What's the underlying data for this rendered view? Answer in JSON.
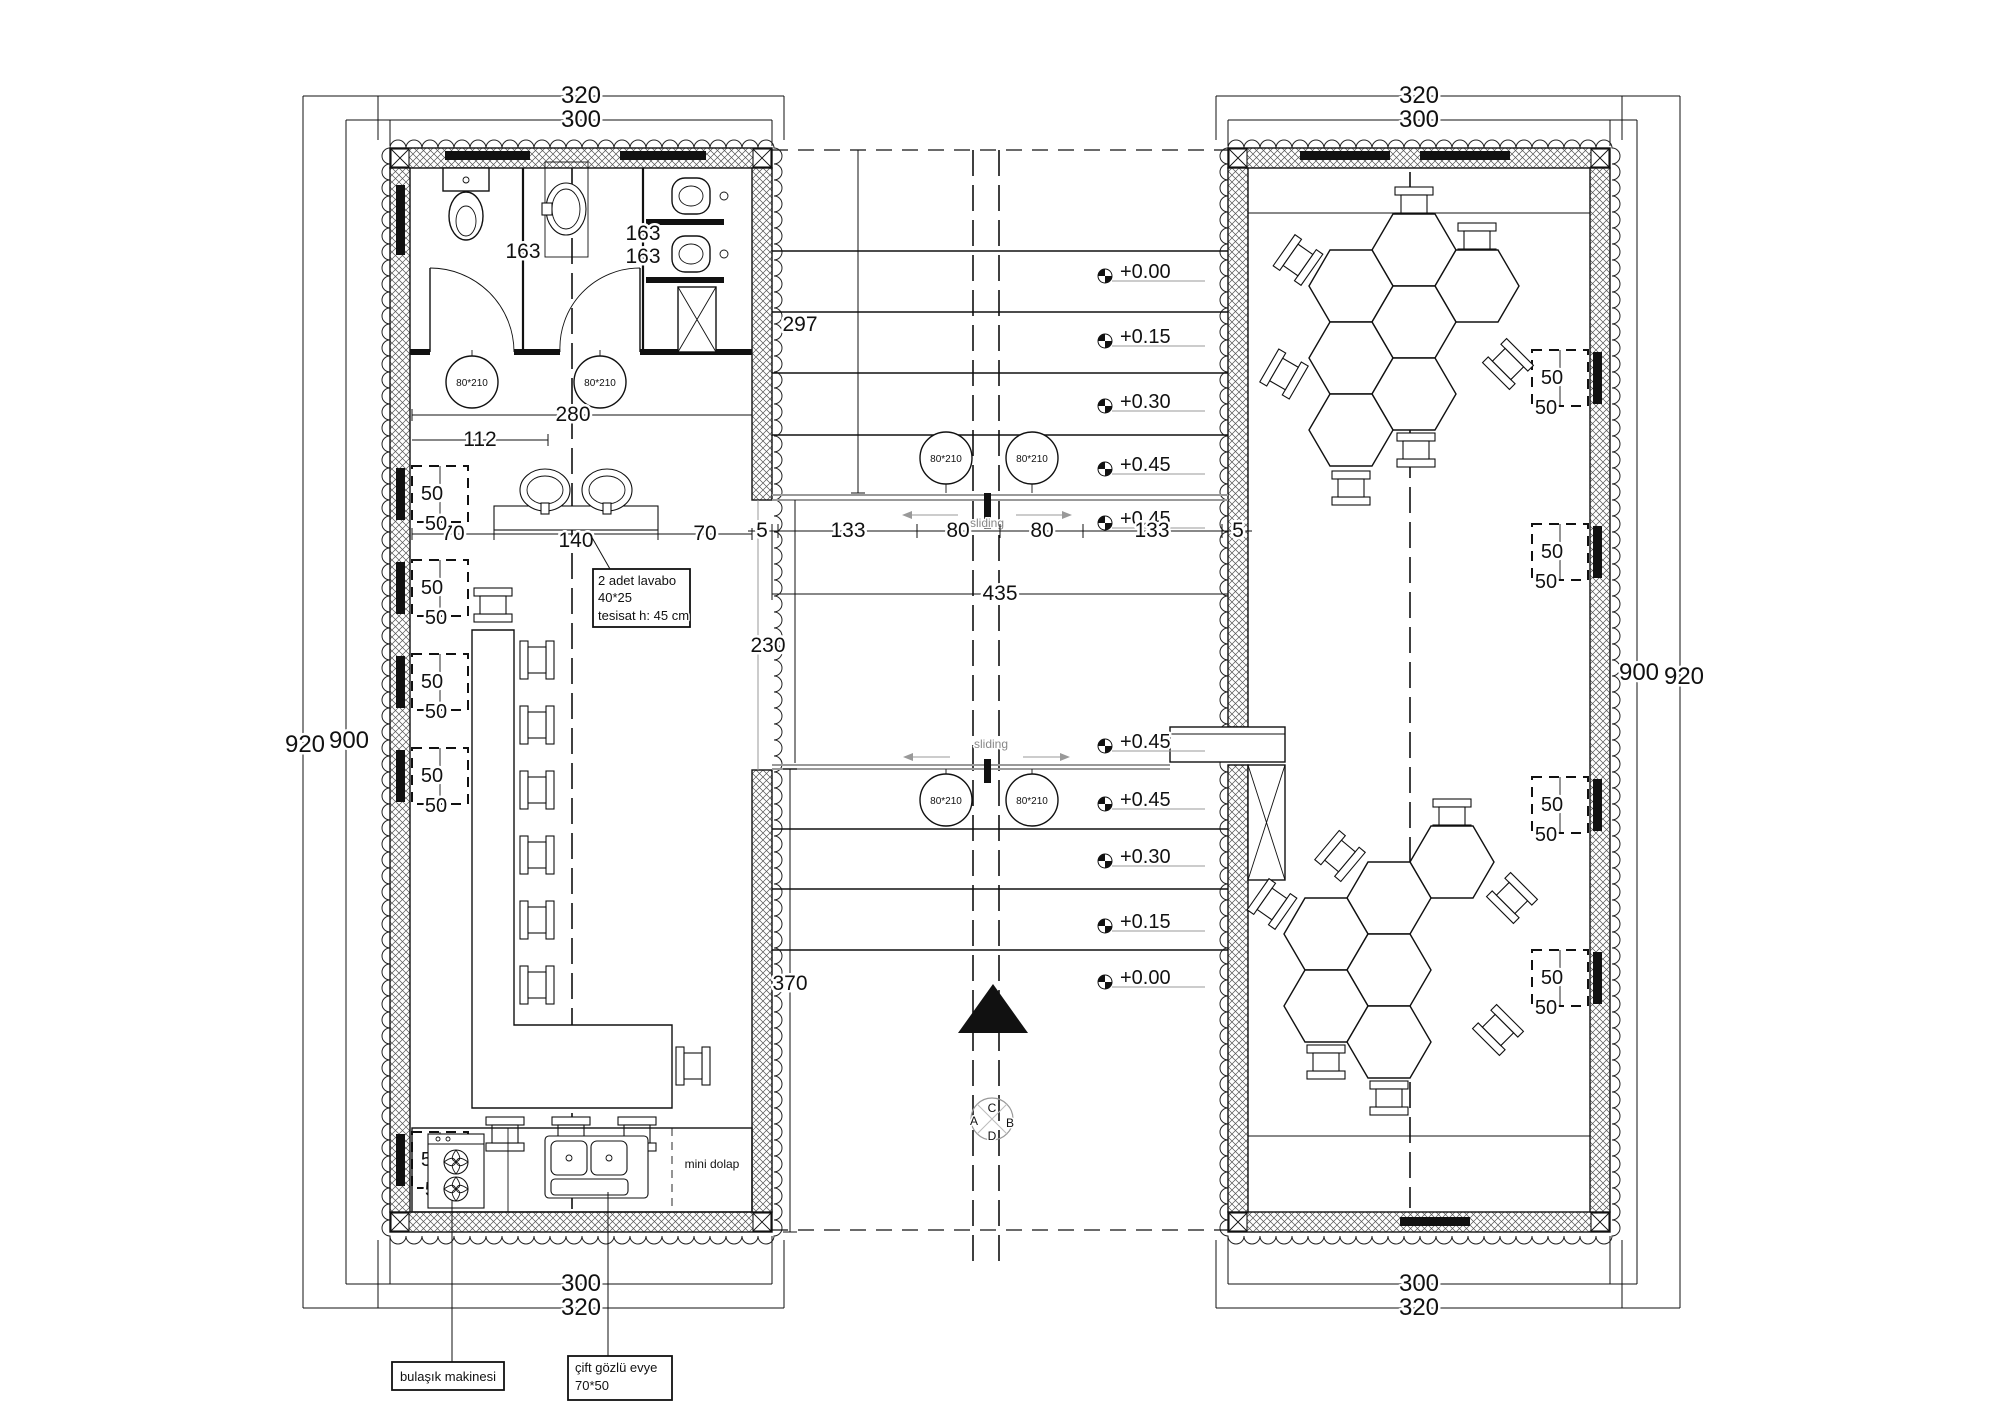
{
  "labels": {
    "seat": "50",
    "door_tag": "80*210",
    "sliding": "sliding"
  },
  "blocks": {
    "left": {
      "top_outer": "320",
      "top_inner": "300",
      "bottom_inner": "300",
      "bottom_outer": "320",
      "side_outer": "920",
      "side_inner": "900"
    },
    "right": {
      "top_outer": "320",
      "top_inner": "300",
      "bottom_inner": "300",
      "bottom_outer": "320",
      "side_inner": "900",
      "side_outer": "920"
    }
  },
  "bathroom": {
    "dim_left_room": "163",
    "dim_right_room_a": "163",
    "dim_right_room_b": "163",
    "dim_width": "280",
    "dim_left_width": "112"
  },
  "lavabo": {
    "dim_left": "70",
    "dim_center": "140",
    "dim_right": "70",
    "note_line1": "2 adet lavabo",
    "note_line2": "40*25",
    "note_line3": "tesisat h: 45 cm"
  },
  "corridor": {
    "dim_height": "297",
    "dim_hall": "230",
    "dim_lower": "370",
    "dim_total": "435",
    "upper_dims": [
      "5",
      "133",
      "80",
      "80",
      "133",
      "5"
    ],
    "upper_levels": [
      "+0.00",
      "+0.15",
      "+0.30",
      "+0.45",
      "+0.45"
    ],
    "lower_levels": [
      "+0.45",
      "+0.45",
      "+0.30",
      "+0.15",
      "+0.00"
    ]
  },
  "kitchen": {
    "dishwasher": "bulaşık makinesi",
    "sink_line1": "çift gözlü evye",
    "sink_line2": "70*50",
    "cabinet": "mini dolap"
  },
  "section_marker": {
    "top": "C",
    "left": "A",
    "right": "B",
    "bottom": "D"
  }
}
